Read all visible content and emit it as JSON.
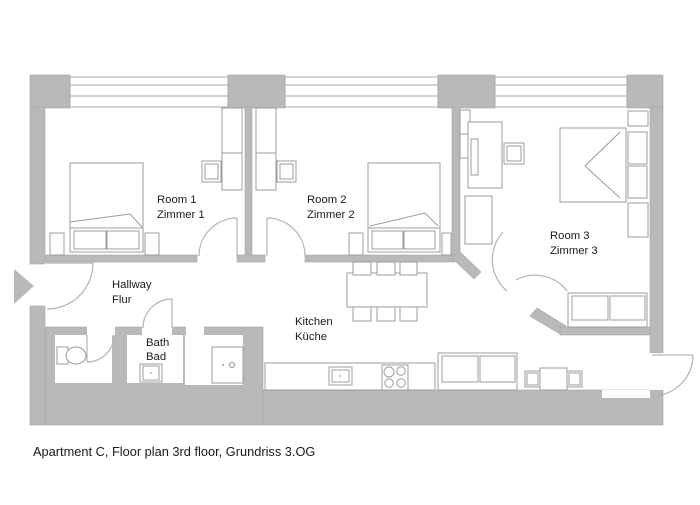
{
  "caption": "Apartment C, Floor plan 3rd floor, Grundriss 3.OG",
  "rooms": {
    "room1": {
      "en": "Room 1",
      "de": "Zimmer 1",
      "furniture": [
        "double bed",
        "nightstands",
        "desk",
        "chair",
        "cabinet"
      ]
    },
    "room2": {
      "en": "Room 2",
      "de": "Zimmer 2",
      "furniture": [
        "double bed",
        "nightstands",
        "desk",
        "chair",
        "cabinet"
      ]
    },
    "room3": {
      "en": "Room 3",
      "de": "Zimmer 3",
      "furniture": [
        "double bed",
        "nightstands",
        "desk",
        "chair",
        "wardrobe",
        "sofa"
      ]
    },
    "hallway": {
      "en": "Hallway",
      "de": "Flur",
      "furniture": []
    },
    "bath": {
      "en": "Bath",
      "de": "Bad",
      "furniture": [
        "toilet",
        "sink",
        "shower"
      ]
    },
    "kitchen": {
      "en": "Kitchen",
      "de": "Küche",
      "furniture": [
        "dining table",
        "6 chairs",
        "counter",
        "sink",
        "stove",
        "sofa",
        "small table",
        "2 chairs"
      ]
    }
  },
  "icons": {
    "entrance": "entrance-arrow"
  },
  "colors": {
    "wall": "#b9b9b9",
    "wall_edge": "#a6a6a6",
    "furniture": "#9c9c9c",
    "door": "#b3b3b3",
    "text": "#1a1a1a",
    "background": "#ffffff"
  }
}
